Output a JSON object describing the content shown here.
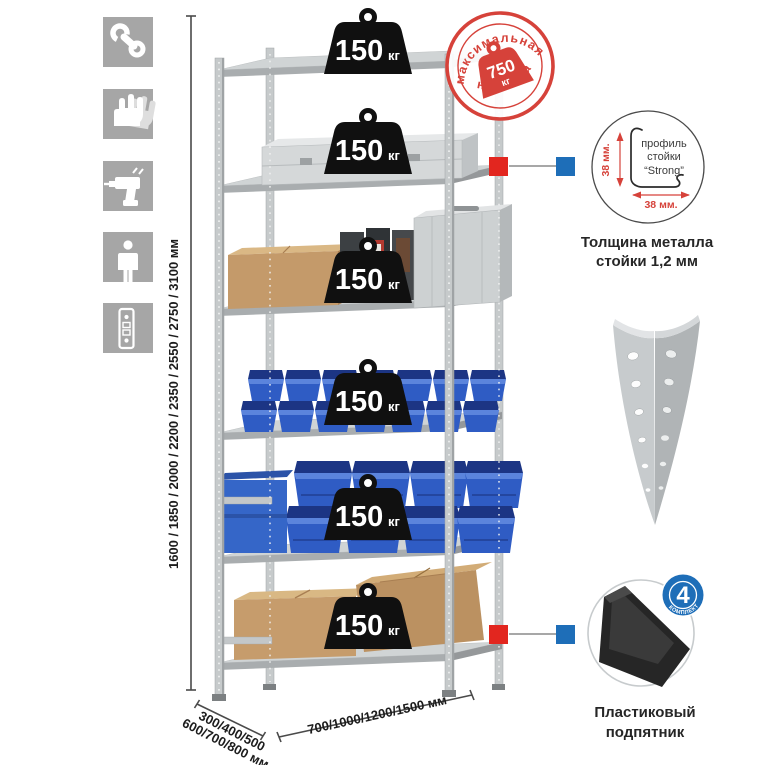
{
  "page": {
    "background": "#ffffff"
  },
  "colors": {
    "accent_red": "#e2261f",
    "accent_blue": "#1e6eb8",
    "stamp_red": "#d6423a",
    "bin_blue": "#2f5cc4",
    "metal_gray": "#c6cacb",
    "icon_bg": "#a6a6a6"
  },
  "feature_icons": [
    {
      "name": "wrench-icon"
    },
    {
      "name": "gloves-icon"
    },
    {
      "name": "drill-icon"
    },
    {
      "name": "person-icon"
    },
    {
      "name": "rack-post-icon"
    }
  ],
  "dimensions": {
    "height_label": "1600 / 1850 / 2000 / 2200 / 2350 / 2550 / 2750 / 3100 мм",
    "depth_line1": "300/400/500",
    "depth_line2": "600/700/800 мм",
    "width_label": "700/1000/1200/1500 мм"
  },
  "stamp": {
    "top": "максимальная",
    "bottom": "нагрузка",
    "value": "750",
    "unit": "кг"
  },
  "rack": {
    "badges": [
      {
        "value": "150",
        "unit": "кг"
      },
      {
        "value": "150",
        "unit": "кг"
      },
      {
        "value": "150",
        "unit": "кг"
      },
      {
        "value": "150",
        "unit": "кг"
      },
      {
        "value": "150",
        "unit": "кг"
      },
      {
        "value": "150",
        "unit": "кг"
      }
    ]
  },
  "profile_detail": {
    "dim_v": "38 мм.",
    "dim_h": "38 мм.",
    "line1": "профиль",
    "line2": "стойки",
    "line3": "“Strong”",
    "caption1": "Толщина металла",
    "caption2": "стойки 1,2 мм"
  },
  "foot_detail": {
    "count": "4",
    "arc": "В КОМПЛЕКТЕ",
    "caption1": "Пластиковый",
    "caption2": "подпятник"
  }
}
